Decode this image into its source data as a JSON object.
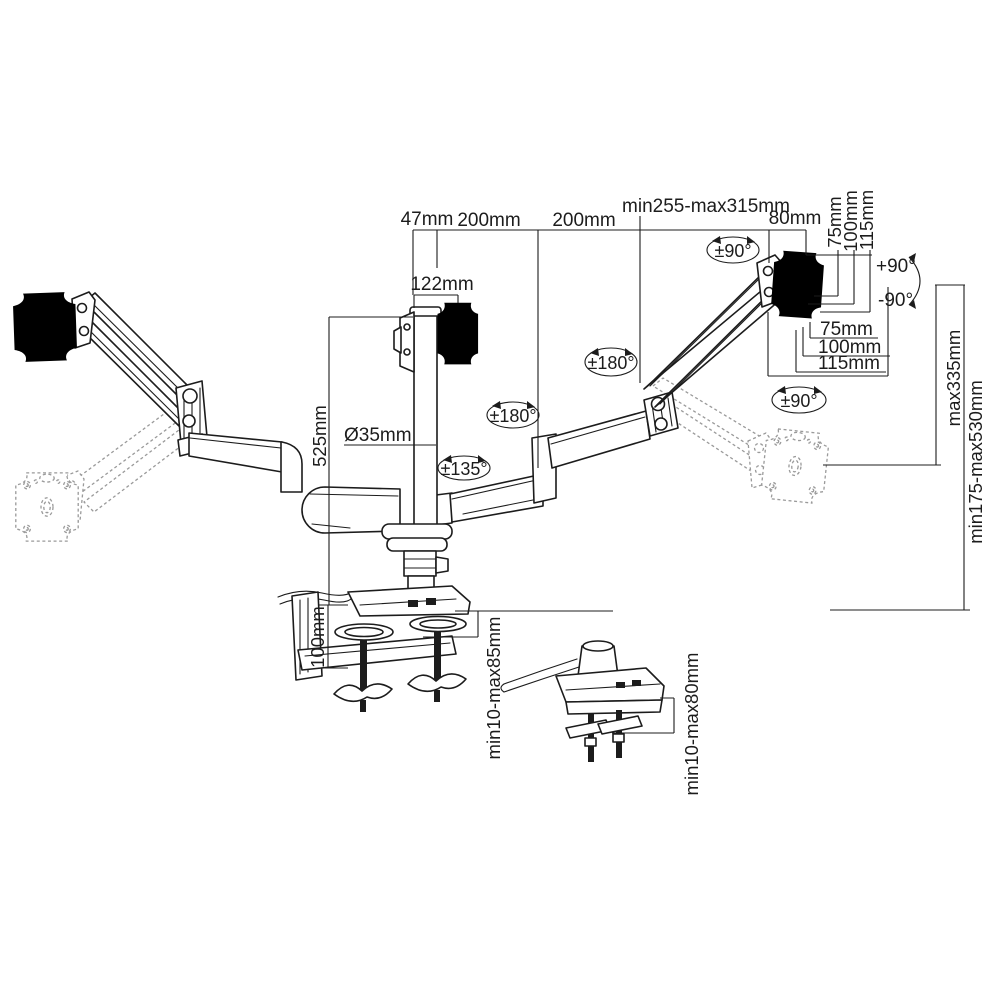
{
  "figure": {
    "type": "technical-line-drawing",
    "subject": "triple monitor gas-spring desk mount arm — dimension diagram",
    "colors": {
      "line": "#1c1c1c",
      "ghost": "#9a9a9a",
      "bg": "#ffffff"
    }
  },
  "labels": {
    "top": {
      "offset47": "47mm",
      "arm200a": "200mm",
      "arm200b": "200mm",
      "reach": "min255-max315mm",
      "end80": "80mm",
      "plate122": "122mm"
    },
    "vesaSide": {
      "v75": "75mm",
      "v100": "100mm",
      "v115": "115mm"
    },
    "vesaUnder": {
      "h75": "75mm",
      "h100": "100mm",
      "h115": "115mm"
    },
    "tilt": {
      "up": "+90°",
      "down": "-90°"
    },
    "rotate": {
      "swivelTop": "±90°",
      "armRight": "±180°",
      "armMid": "±180°",
      "armCenter": "±135°",
      "vesaRight": "±90°"
    },
    "pole": {
      "height": "525mm",
      "diameter": "Ø35mm"
    },
    "clamp": {
      "height": "100mm",
      "deskThickness": "min10-max85mm"
    },
    "grommet": {
      "deskThickness": "min10-max80mm"
    },
    "heightRange": {
      "max": "max335mm",
      "minMax": "min175-max530mm"
    }
  }
}
